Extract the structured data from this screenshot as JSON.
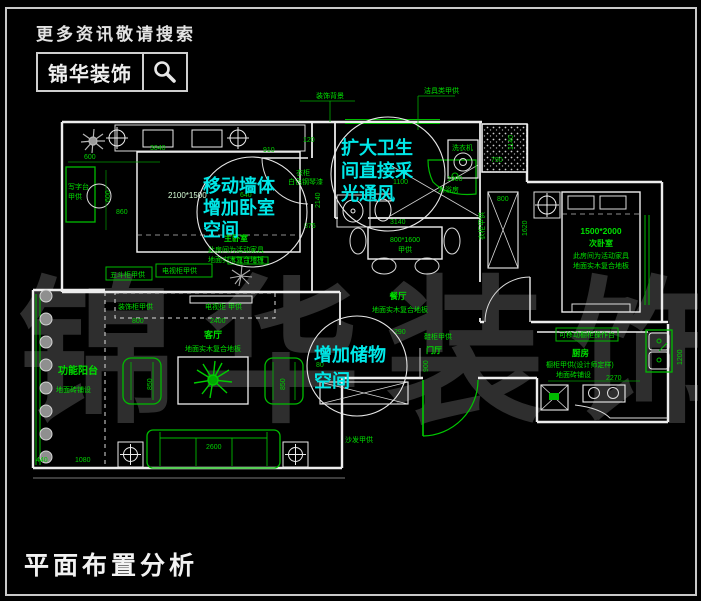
{
  "header": {
    "search_hint": "更多资讯敬请搜索",
    "brand": "锦华装饰"
  },
  "footer": {
    "title": "平面布置分析"
  },
  "watermark": {
    "text": "锦华装饰"
  },
  "colors": {
    "wall": "#ededed",
    "furniture_green": "#00bb00",
    "text_green": "#00e000",
    "annotation_cyan": "#00e8e8",
    "background": "#000000"
  },
  "annotations": {
    "bubble_bedroom": {
      "line1": "移动墙体",
      "line2": "增加卧室",
      "line3": "空间"
    },
    "bubble_bathroom": {
      "line1": "扩大卫生",
      "line2": "间直接采",
      "line3": "光通风"
    },
    "bubble_storage": {
      "line1": "增加储物",
      "line2": "空间"
    }
  },
  "rooms": {
    "master_bedroom": {
      "name": "主卧室",
      "note1": "此房间为活动家具",
      "note2": "地面实木复合地板",
      "bed_size": "2100*1500"
    },
    "second_bedroom": {
      "name": "次卧室",
      "bed_size": "1500*2000",
      "note1": "此房间为活动家具",
      "note2": "地面实木复合地板"
    },
    "living": {
      "name": "客厅",
      "floor": "地面实木复合地板"
    },
    "dining": {
      "name": "餐厅",
      "floor": "地面实木复合地板"
    },
    "kitchen": {
      "name": "厨房",
      "note1": "橱柜甲供(设计师定样)",
      "note2": "地面砖铺设"
    },
    "balcony": {
      "name": "功能阳台",
      "floor": "地面砖铺设"
    },
    "entry": {
      "name": "门厅"
    },
    "bathroom": {
      "shower": "淋浴房",
      "washer": "洗衣机"
    }
  },
  "labels": {
    "deco_bg": "装饰背景",
    "sanitary": "洁具类甲供",
    "desk1": "写字台",
    "desk2": "甲供",
    "chest": "五斗柜甲供",
    "tv_master": "电视柜甲供",
    "closet1": "衣柜",
    "closet2": "白色钢琴漆",
    "deco_cabinet": "装饰柜甲供",
    "tv_living": "电视柜 甲供",
    "sofa": "沙发甲供",
    "shoe_cabinet": "鞋柜甲供",
    "wardrobe_second": "衣柜甲供",
    "platform": "可移动橱柜操作台",
    "table_size": "800*1600",
    "table_supply": "甲供"
  },
  "dims": {
    "d600": "600",
    "d600v": "600",
    "d3040": "3040",
    "d860": "860",
    "d640": "640",
    "d120": "120",
    "d910": "910",
    "d2140": "2140",
    "d875": "875",
    "d3140": "3140",
    "d1000": "1000",
    "d1100": "1100",
    "d790": "790",
    "d1140": "1140",
    "d800w": "800",
    "d1620": "1620",
    "d290": "290",
    "d900": "900",
    "d80": "80",
    "d800l": "800",
    "d2400": "2400",
    "d850l": "850",
    "d850r": "850",
    "d2600": "2600",
    "d440": "440",
    "d1080": "1080",
    "d2270": "2270",
    "d1200": "1200"
  }
}
